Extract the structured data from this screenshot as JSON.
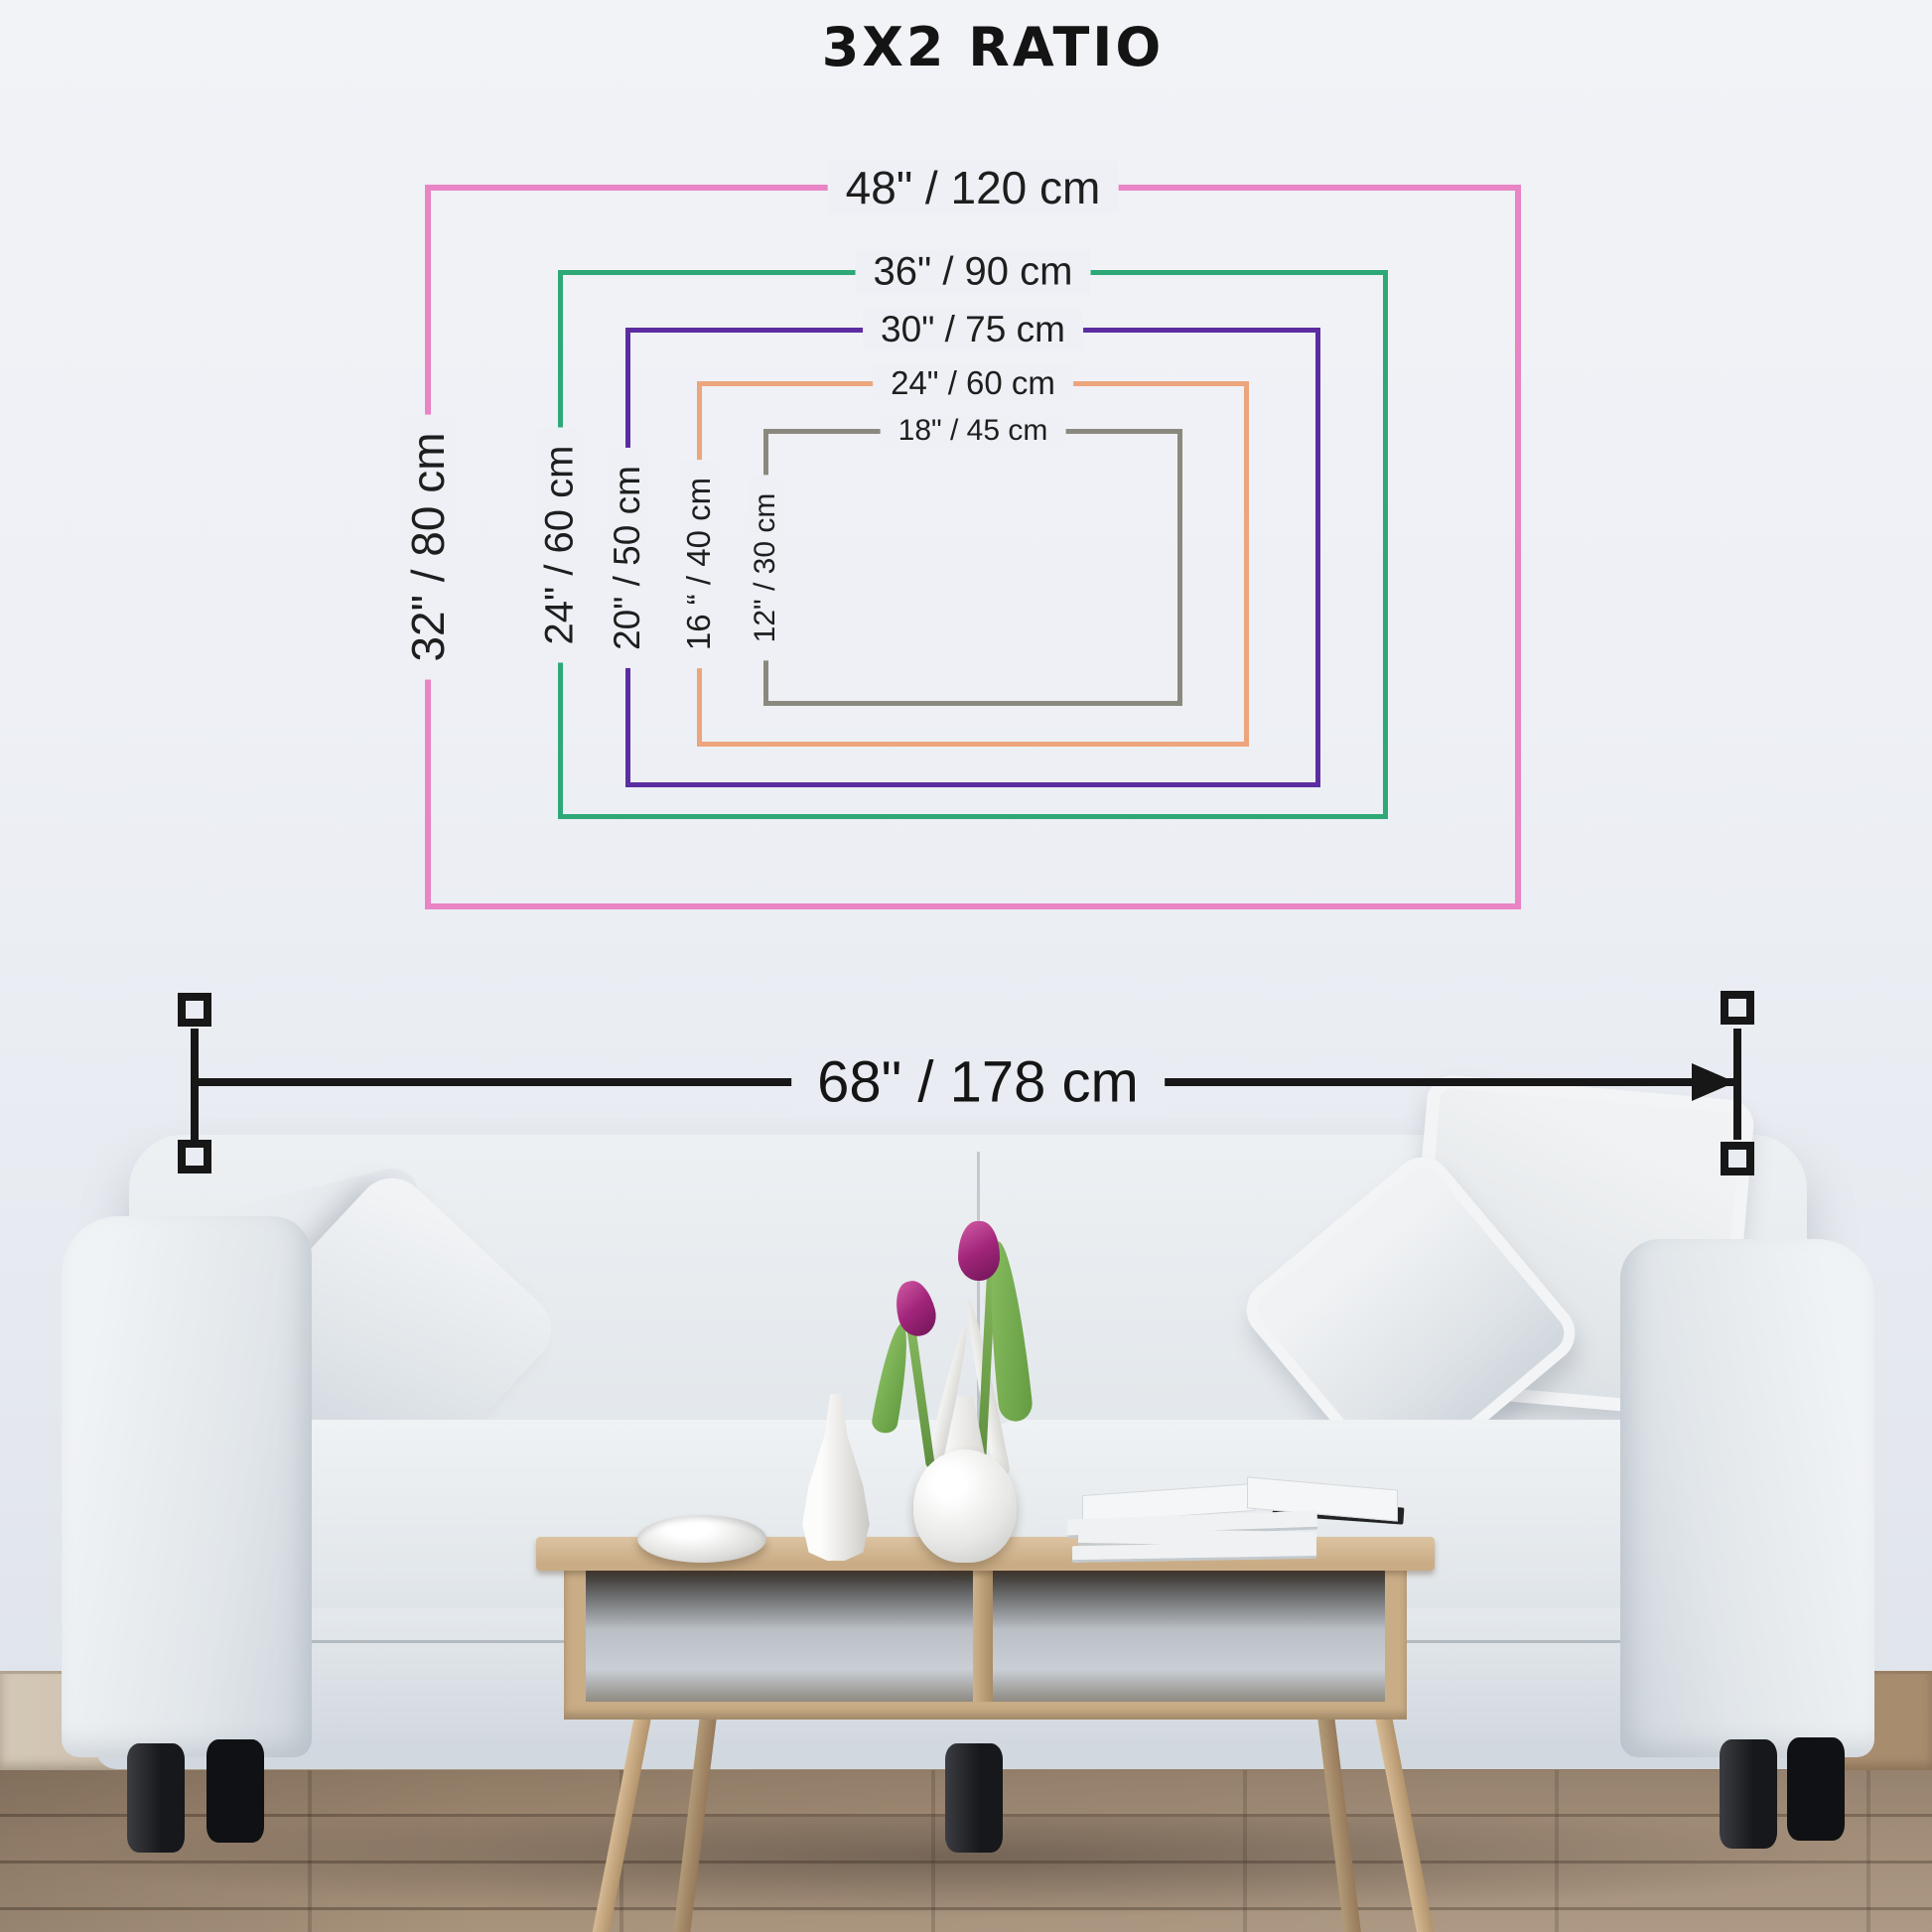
{
  "title": "3X2 RATIO",
  "frames": [
    {
      "width_label": "48\" / 120 cm",
      "height_label": "32\" / 80 cm",
      "color": "#e984c5"
    },
    {
      "width_label": "36\" / 90 cm",
      "height_label": "24\" / 60 cm",
      "color": "#2fa878"
    },
    {
      "width_label": "30\" / 75 cm",
      "height_label": "20\" / 50 cm",
      "color": "#5c2da0"
    },
    {
      "width_label": "24\" / 60 cm",
      "height_label": "16 “ / 40 cm",
      "color": "#eca57c"
    },
    {
      "width_label": "18\" / 45 cm",
      "height_label": "12\" / 30 cm",
      "color": "#8a897e"
    }
  ],
  "measurement": {
    "label": "68\" / 178 cm",
    "line_color": "#171717"
  }
}
